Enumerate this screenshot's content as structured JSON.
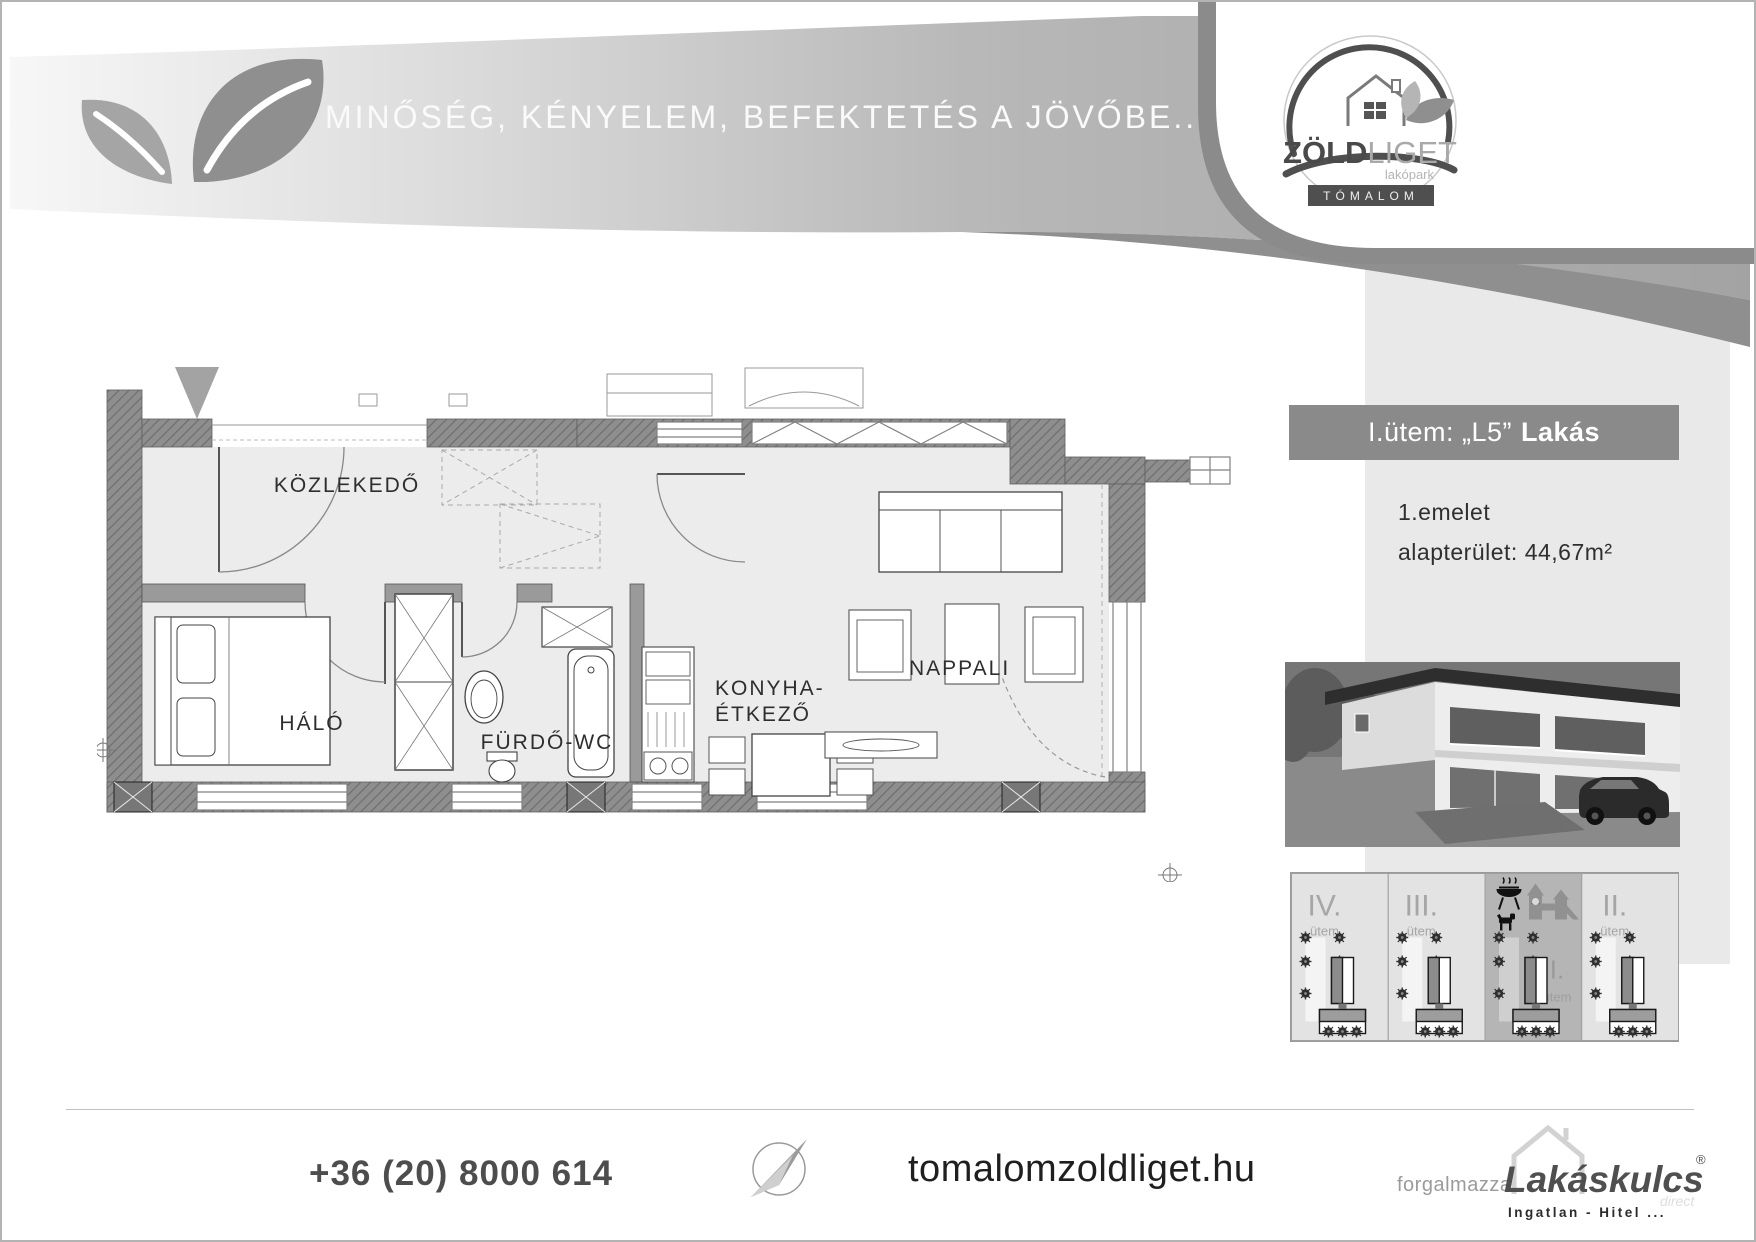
{
  "colors": {
    "band_gray": "#b0b0b0",
    "panel_gray": "#e9e9e9",
    "bar_gray": "#8a8a8a",
    "wall_gray": "#8e8e8e",
    "highlight_panel": "#b5b5b5",
    "text_dark": "#2f2f2f"
  },
  "header": {
    "tagline": "MINŐSÉG, KÉNYELEM, BEFEKTETÉS A JÖVŐBE...",
    "logo": {
      "brand_bold": "ZÖLD",
      "brand_light": "LIGET",
      "subtitle": "lakópark",
      "location": "TÓMALOM"
    }
  },
  "sidebar": {
    "unit_header": {
      "prefix": "I.ütem: „L5”",
      "name": "Lakás"
    },
    "floor": "1.emelet",
    "area": "alapterület: 44,67m²",
    "site_map": {
      "phases": [
        {
          "numeral": "IV.",
          "label": "ütem",
          "highlighted": false
        },
        {
          "numeral": "III.",
          "label": "ütem",
          "highlighted": false
        },
        {
          "numeral": "I.",
          "label": "ütem",
          "highlighted": true
        },
        {
          "numeral": "II.",
          "label": "ütem",
          "highlighted": false
        }
      ]
    }
  },
  "floor_plan": {
    "rooms": {
      "hall": "KÖZLEKEDŐ",
      "bedroom": "HÁLÓ",
      "bathroom": "FÜRDŐ-WC",
      "kitchen_line1": "KONYHA-",
      "kitchen_line2": "ÉTKEZŐ",
      "living": "NAPPALI"
    }
  },
  "footer": {
    "phone": "+36 (20) 8000 614",
    "website": "tomalomzoldliget.hu",
    "distributor_label": "forgalmazza:",
    "distributor": {
      "name": "Lakáskulcs",
      "registered": "®",
      "sub_brand": "direct",
      "tagline": "Ingatlan - Hitel ..."
    }
  }
}
